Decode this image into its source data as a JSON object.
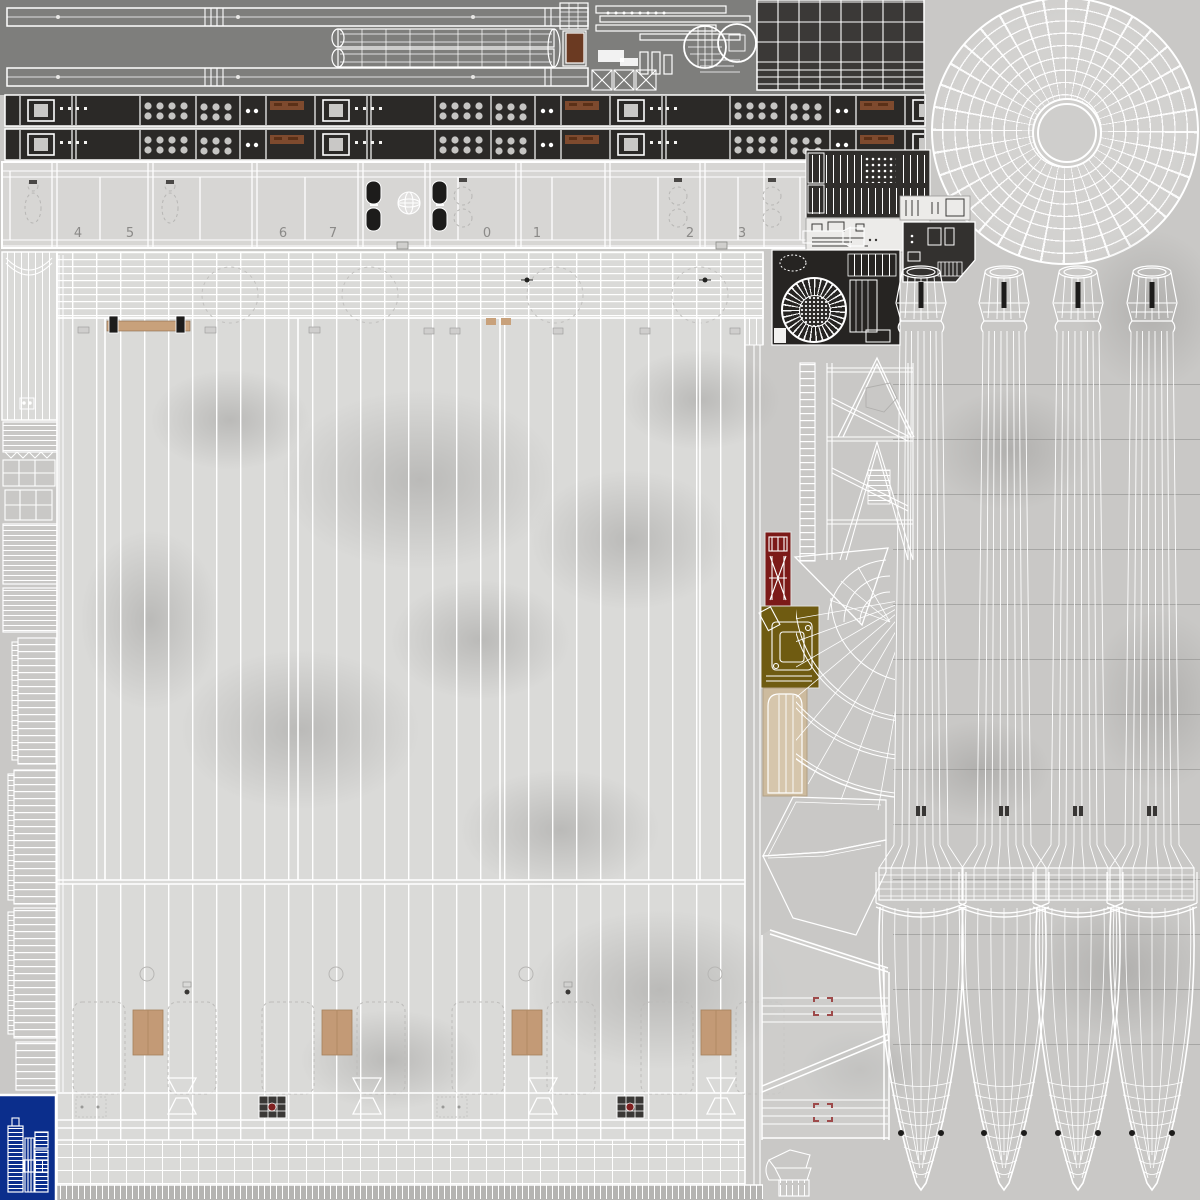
{
  "sheet": {
    "kind": "uv-texture-atlas-wireframe",
    "panel_numbers": [
      "4",
      "5",
      "6",
      "7",
      "0",
      "1",
      "2",
      "3"
    ],
    "colors": {
      "background": "#c9c8c6",
      "top_band_gray": "#7e7e7c",
      "window_strip_dark": "#2b2927",
      "instrument_grid_dark": "#3b3937",
      "number_band_light": "#d7d6d4",
      "envelope_light": "#dadad8",
      "wireframe_white": "#ffffff",
      "rust_patch": "#7e4a2e",
      "ramp_tan": "#c8a17b",
      "door_tan": "#c39a76",
      "plank_door_beige": "#cdbb9e",
      "red_part": "#7c1a18",
      "olive_part": "#6f5b11",
      "hatch_panel_dark": "#33312f",
      "registration_red": "#9e4a4a",
      "window_black": "#1d1c1b",
      "logo_blue": "#0b2e8c",
      "seam_gray": "#b5b4b2"
    }
  }
}
